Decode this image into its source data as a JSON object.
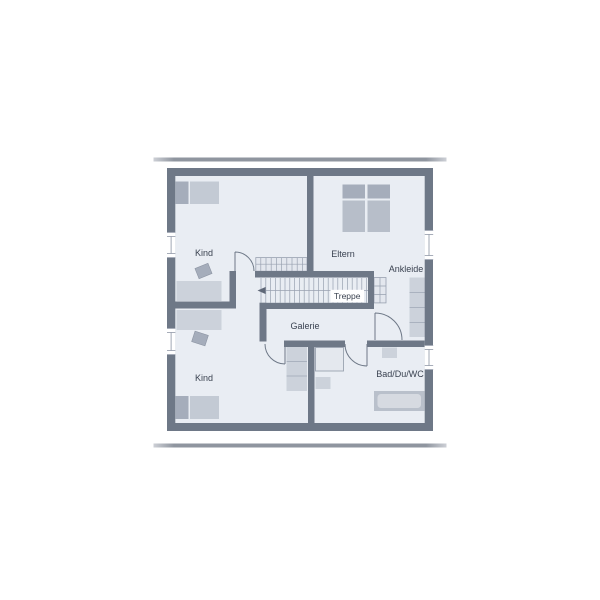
{
  "palette": {
    "wall": "#6e7887",
    "floor": "#e9edf3",
    "stair_fill": "#e3e7ee",
    "hatch_line": "#98a1b0",
    "furniture_light": "#ccd2db",
    "furniture_medium": "#b7bec9",
    "furniture_dark": "#a5adbb",
    "door_arc": "#6e7887",
    "text": "#3a4250",
    "divider_bar": "#8f959f",
    "label_box": "#ffffff"
  },
  "labels": {
    "room_kind_top": "Kind",
    "room_eltern": "Eltern",
    "room_ankleide": "Ankleide",
    "stair": "Treppe",
    "room_galerie": "Galerie",
    "room_kind_bottom": "Kind",
    "room_bad": "Bad/Du/WC"
  }
}
